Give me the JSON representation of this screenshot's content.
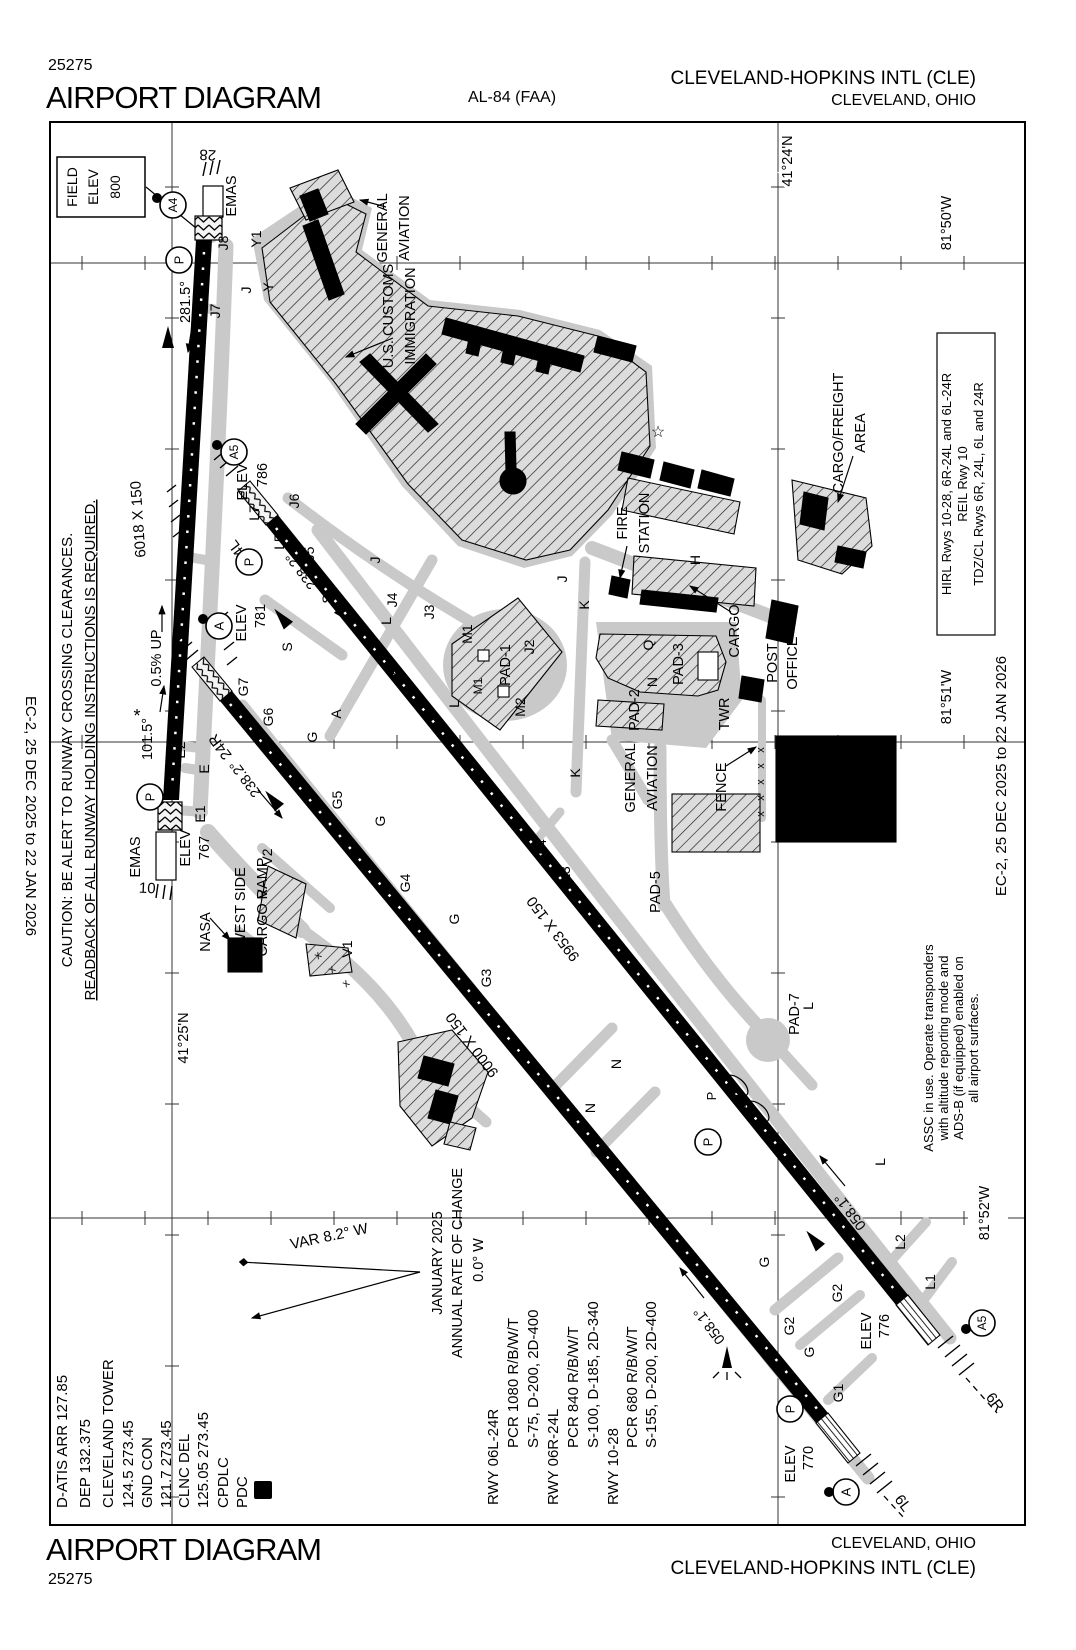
{
  "header": {
    "chart_id": "25275",
    "title": "AIRPORT DIAGRAM",
    "procedure_id": "AL-84 (FAA)",
    "airport_name": "CLEVELAND-HOPKINS INTL (CLE)",
    "city": "CLEVELAND, OHIO"
  },
  "footer": {
    "title": "AIRPORT DIAGRAM",
    "chart_id": "25275",
    "city": "CLEVELAND, OHIO",
    "airport_name": "CLEVELAND-HOPKINS INTL (CLE)"
  },
  "margins": {
    "left_date": "EC-2,  25 DEC 2025  to  22 JAN 2026",
    "right_date": "EC-2,  25 DEC 2025  to  22 JAN 2026"
  },
  "map": {
    "pdc_d": "D",
    "caution": [
      {
        "t": "CAUTION: BE ALERT TO RUNWAY CROSSING CLEARANCES.",
        "x": 72,
        "y": 750,
        "s": 15
      },
      {
        "t": "READBACK OF ALL RUNWAY HOLDING INSTRUCTIONS IS REQUIRED.",
        "x": 95,
        "y": 750,
        "s": 15,
        "u": 1
      }
    ],
    "frequencies": [
      {
        "t": "D-ATIS ARR 127.85",
        "x": 67,
        "y": 1508,
        "a": "s",
        "s": 15
      },
      {
        "t": "DEP 132.375",
        "x": 90,
        "y": 1508,
        "a": "s",
        "s": 15
      },
      {
        "t": "CLEVELAND TOWER",
        "x": 113,
        "y": 1508,
        "a": "s",
        "s": 15
      },
      {
        "t": "124.5  273.45",
        "x": 133,
        "y": 1508,
        "a": "s",
        "s": 15
      },
      {
        "t": "GND CON",
        "x": 152,
        "y": 1508,
        "a": "s",
        "s": 15
      },
      {
        "t": "121.7  273.45",
        "x": 171,
        "y": 1508,
        "a": "s",
        "s": 15
      },
      {
        "t": "CLNC DEL",
        "x": 189,
        "y": 1508,
        "a": "s",
        "s": 15
      },
      {
        "t": "125.05  273.45",
        "x": 208,
        "y": 1508,
        "a": "s",
        "s": 15
      },
      {
        "t": "CPDLC",
        "x": 228,
        "y": 1508,
        "a": "s",
        "s": 15
      },
      {
        "t": "PDC",
        "x": 247,
        "y": 1508,
        "a": "s",
        "s": 15
      }
    ],
    "runway_data": [
      {
        "t": "RWY 06L-24R",
        "x": 498,
        "y": 1505,
        "a": "s",
        "s": 15
      },
      {
        "t": "PCR 1080 R/B/W/T",
        "x": 518,
        "y": 1448,
        "a": "s",
        "s": 15
      },
      {
        "t": "S-75, D-200, 2D-400",
        "x": 538,
        "y": 1448,
        "a": "s",
        "s": 15
      },
      {
        "t": "RWY 06R-24L",
        "x": 558,
        "y": 1505,
        "a": "s",
        "s": 15
      },
      {
        "t": "PCR 840 R/B/W/T",
        "x": 578,
        "y": 1448,
        "a": "s",
        "s": 15
      },
      {
        "t": "S-100, D-185, 2D-340",
        "x": 598,
        "y": 1448,
        "a": "s",
        "s": 15
      },
      {
        "t": "RWY 10-28",
        "x": 618,
        "y": 1505,
        "a": "s",
        "s": 15
      },
      {
        "t": "PCR 680 R/B/W/T",
        "x": 637,
        "y": 1448,
        "a": "s",
        "s": 15
      },
      {
        "t": "S-155, D-200, 2D-400",
        "x": 656,
        "y": 1448,
        "a": "s",
        "s": 15
      }
    ],
    "lighting_note": [
      {
        "t": "HIRL Rwys 10-28, 6R-24L and 6L-24R",
        "x": 951,
        "y": 484,
        "s": 13
      },
      {
        "t": "REIL Rwy 10",
        "x": 967,
        "y": 484,
        "s": 13
      },
      {
        "t": "TDZ/CL Rwys 6R, 24L, 6L and 24R",
        "x": 983,
        "y": 484,
        "s": 13
      }
    ],
    "assc_note": [
      {
        "t": "ASSC in use. Operate transponders",
        "x": 933,
        "y": 1048,
        "s": 13
      },
      {
        "t": "with altitude reporting mode and",
        "x": 948,
        "y": 1048,
        "s": 13
      },
      {
        "t": "ADS-B (if equipped) enabled on",
        "x": 963,
        "y": 1048,
        "s": 13
      },
      {
        "t": "all airport surfaces.",
        "x": 978,
        "y": 1048,
        "s": 13
      }
    ],
    "field_elev_box": [
      {
        "t": "FIELD",
        "x": 77,
        "y": 187,
        "s": 14
      },
      {
        "t": "ELEV",
        "x": 98,
        "y": 187,
        "s": 14
      },
      {
        "t": "800",
        "x": 120,
        "y": 187,
        "s": 14
      }
    ],
    "labels": [
      {
        "t": "28",
        "x": 208,
        "y": 150,
        "r": 183,
        "s": 15
      },
      {
        "t": "EMAS",
        "x": 236,
        "y": 196
      },
      {
        "t": "J8",
        "x": 228,
        "y": 243,
        "s": 14
      },
      {
        "t": "J7",
        "x": 220,
        "y": 311,
        "s": 14
      },
      {
        "t": "Y1",
        "x": 261,
        "y": 239,
        "s": 14
      },
      {
        "t": "J",
        "x": 251,
        "y": 290,
        "s": 14
      },
      {
        "t": "Y",
        "x": 273,
        "y": 287,
        "s": 14
      },
      {
        "t": "281.5°",
        "x": 190,
        "y": 302
      },
      {
        "t": "6018 X 150",
        "x": 143,
        "y": 519,
        "r": -94,
        "s": 15
      },
      {
        "t": "0.5% UP",
        "x": 161,
        "y": 658
      },
      {
        "t": "101.5°",
        "x": 152,
        "y": 739
      },
      {
        "t": "*",
        "x": 137,
        "y": 722,
        "r": 0,
        "s": 18
      },
      {
        "t": "E2",
        "x": 185,
        "y": 750,
        "s": 14
      },
      {
        "t": "E",
        "x": 209,
        "y": 769,
        "s": 14
      },
      {
        "t": "E1",
        "x": 205,
        "y": 814,
        "s": 14
      },
      {
        "t": "EMAS",
        "x": 140,
        "y": 857
      },
      {
        "t": "10",
        "x": 147,
        "y": 893,
        "r": 3,
        "s": 15
      },
      {
        "t": "ELEV",
        "x": 190,
        "y": 848
      },
      {
        "t": "767",
        "x": 209,
        "y": 848
      },
      {
        "t": "GENERAL",
        "x": 387,
        "y": 228
      },
      {
        "t": "AVIATION",
        "x": 409,
        "y": 228
      },
      {
        "t": "U.S. CUSTOMS",
        "x": 393,
        "y": 316
      },
      {
        "t": "IMMIGRATION",
        "x": 415,
        "y": 316
      },
      {
        "t": "L7",
        "x": 259,
        "y": 513,
        "s": 14
      },
      {
        "t": "J6",
        "x": 299,
        "y": 501,
        "s": 14
      },
      {
        "t": "24L",
        "x": 243,
        "y": 549,
        "r": -127,
        "s": 15
      },
      {
        "t": "ELEV",
        "x": 247,
        "y": 482
      },
      {
        "t": "786",
        "x": 267,
        "y": 475
      },
      {
        "t": "S",
        "x": 332,
        "y": 599,
        "s": 14
      },
      {
        "t": "238.2°",
        "x": 305,
        "y": 568,
        "r": -127
      },
      {
        "t": "L5",
        "x": 284,
        "y": 542,
        "s": 14
      },
      {
        "t": "J5",
        "x": 314,
        "y": 554,
        "s": 14
      },
      {
        "t": "ELEV",
        "x": 246,
        "y": 623
      },
      {
        "t": "781",
        "x": 265,
        "y": 616
      },
      {
        "t": "S",
        "x": 292,
        "y": 647,
        "s": 14
      },
      {
        "t": "24R",
        "x": 224,
        "y": 744,
        "r": -127,
        "s": 15
      },
      {
        "t": "G7",
        "x": 248,
        "y": 687,
        "s": 14
      },
      {
        "t": "G6",
        "x": 273,
        "y": 717,
        "s": 14
      },
      {
        "t": "238.2°",
        "x": 249,
        "y": 776,
        "r": -127
      },
      {
        "t": "A",
        "x": 397,
        "y": 671,
        "s": 14
      },
      {
        "t": "A",
        "x": 341,
        "y": 714,
        "s": 14
      },
      {
        "t": "G",
        "x": 317,
        "y": 737,
        "s": 14
      },
      {
        "t": "J",
        "x": 380,
        "y": 560,
        "s": 14
      },
      {
        "t": "L",
        "x": 391,
        "y": 621,
        "s": 14
      },
      {
        "t": "J4",
        "x": 397,
        "y": 600,
        "s": 14
      },
      {
        "t": "J3",
        "x": 434,
        "y": 612,
        "s": 14
      },
      {
        "t": "J2",
        "x": 534,
        "y": 647,
        "s": 14
      },
      {
        "t": "L",
        "x": 459,
        "y": 704,
        "s": 14
      },
      {
        "t": "G5",
        "x": 342,
        "y": 800,
        "s": 14
      },
      {
        "t": "G",
        "x": 385,
        "y": 821,
        "s": 14
      },
      {
        "t": "G4",
        "x": 410,
        "y": 883,
        "s": 14
      },
      {
        "t": "G",
        "x": 459,
        "y": 919,
        "s": 14
      },
      {
        "t": "G3",
        "x": 491,
        "y": 978,
        "s": 14
      },
      {
        "t": "L4",
        "x": 546,
        "y": 847,
        "s": 14
      },
      {
        "t": "L3",
        "x": 570,
        "y": 874,
        "s": 14
      },
      {
        "t": "9953 X 150",
        "x": 557,
        "y": 926,
        "r": -127,
        "s": 15
      },
      {
        "t": "9000 X 150",
        "x": 476,
        "y": 1042,
        "r": -127,
        "s": 15
      },
      {
        "t": "J",
        "x": 567,
        "y": 579,
        "s": 14
      },
      {
        "t": "K",
        "x": 589,
        "y": 605,
        "s": 14
      },
      {
        "t": "H",
        "x": 700,
        "y": 560,
        "s": 14
      },
      {
        "t": "FIRE",
        "x": 627,
        "y": 523
      },
      {
        "t": "STATION",
        "x": 649,
        "y": 523
      },
      {
        "t": "CARGO",
        "x": 739,
        "y": 631
      },
      {
        "t": "POST",
        "x": 777,
        "y": 663
      },
      {
        "t": "OFFICE",
        "x": 797,
        "y": 663
      },
      {
        "t": "TWR",
        "x": 729,
        "y": 714
      },
      {
        "t": "Q",
        "x": 653,
        "y": 645,
        "s": 14
      },
      {
        "t": "N",
        "x": 657,
        "y": 682,
        "s": 14
      },
      {
        "t": "PAD-1",
        "x": 510,
        "y": 665
      },
      {
        "t": "M1",
        "x": 472,
        "y": 634,
        "s": 14
      },
      {
        "t": "M1",
        "x": 482,
        "y": 686,
        "s": 12
      },
      {
        "t": "M2",
        "x": 525,
        "y": 707,
        "s": 14
      },
      {
        "t": "PAD-2",
        "x": 639,
        "y": 710
      },
      {
        "t": "PAD-3",
        "x": 683,
        "y": 664
      },
      {
        "t": "FENCE",
        "x": 726,
        "y": 787
      },
      {
        "t": "K",
        "x": 580,
        "y": 773,
        "s": 14
      },
      {
        "t": "GENERAL",
        "x": 635,
        "y": 778
      },
      {
        "t": "AVIATION",
        "x": 657,
        "y": 778
      },
      {
        "t": "CARGO/FREIGHT",
        "x": 843,
        "y": 433
      },
      {
        "t": "AREA",
        "x": 865,
        "y": 433
      },
      {
        "t": "☆",
        "x": 658,
        "y": 437,
        "r": 0,
        "s": 16
      },
      {
        "t": "PAD-5",
        "x": 660,
        "y": 892
      },
      {
        "t": "PAD-7",
        "x": 799,
        "y": 1014
      },
      {
        "t": "L",
        "x": 813,
        "y": 1006,
        "s": 14
      },
      {
        "t": "L",
        "x": 885,
        "y": 1162,
        "s": 14
      },
      {
        "t": "N",
        "x": 595,
        "y": 1108,
        "s": 14
      },
      {
        "t": "N",
        "x": 621,
        "y": 1064,
        "s": 14
      },
      {
        "t": "P",
        "x": 716,
        "y": 1096,
        "s": 13
      },
      {
        "t": "x",
        "x": 764,
        "y": 750,
        "s": 11
      },
      {
        "t": "x",
        "x": 764,
        "y": 766,
        "s": 11
      },
      {
        "t": "x",
        "x": 764,
        "y": 782,
        "s": 11
      },
      {
        "t": "x",
        "x": 764,
        "y": 798,
        "s": 11
      },
      {
        "t": "x",
        "x": 764,
        "y": 814,
        "s": 11
      },
      {
        "t": "NASA",
        "x": 210,
        "y": 932
      },
      {
        "t": "WEST SIDE",
        "x": 245,
        "y": 907
      },
      {
        "t": "CARGO RAMP",
        "x": 267,
        "y": 907
      },
      {
        "t": "V2",
        "x": 272,
        "y": 857,
        "s": 14
      },
      {
        "t": "V",
        "x": 267,
        "y": 894,
        "s": 14
      },
      {
        "t": "V1",
        "x": 352,
        "y": 949,
        "s": 14
      },
      {
        "t": "x",
        "x": 320,
        "y": 958,
        "r": -40,
        "s": 11
      },
      {
        "t": "x",
        "x": 334,
        "y": 972,
        "r": -40,
        "s": 11
      },
      {
        "t": "x",
        "x": 348,
        "y": 986,
        "r": -40,
        "s": 11
      },
      {
        "t": "ELEV",
        "x": 871,
        "y": 1331
      },
      {
        "t": "776",
        "x": 889,
        "y": 1326
      },
      {
        "t": "058.1°",
        "x": 854,
        "y": 1209,
        "r": -127
      },
      {
        "t": "6R",
        "x": 991,
        "y": 1405,
        "r": 53,
        "s": 15
      },
      {
        "t": "L2",
        "x": 905,
        "y": 1242,
        "s": 14
      },
      {
        "t": "L1",
        "x": 935,
        "y": 1282,
        "s": 14
      },
      {
        "t": "G2",
        "x": 842,
        "y": 1293,
        "s": 14
      },
      {
        "t": "G2",
        "x": 794,
        "y": 1326,
        "s": 14
      },
      {
        "t": "G",
        "x": 769,
        "y": 1262,
        "s": 14
      },
      {
        "t": "G",
        "x": 814,
        "y": 1352,
        "s": 14
      },
      {
        "t": "G1",
        "x": 843,
        "y": 1393,
        "s": 14
      },
      {
        "t": "058.1°",
        "x": 713,
        "y": 1323,
        "r": -127
      },
      {
        "t": "ELEV",
        "x": 795,
        "y": 1464
      },
      {
        "t": "770",
        "x": 813,
        "y": 1458
      },
      {
        "t": "6L",
        "x": 899,
        "y": 1506,
        "r": 53,
        "s": 15
      },
      {
        "t": "41°24'N",
        "x": 792,
        "y": 161,
        "h": 1
      },
      {
        "t": "41°25'N",
        "x": 188,
        "y": 1038,
        "h": 1
      },
      {
        "t": "81°50'W",
        "x": 951,
        "y": 223,
        "h": 1
      },
      {
        "t": "81°51'W",
        "x": 951,
        "y": 697,
        "h": 1
      },
      {
        "t": "81°52'W",
        "x": 989,
        "y": 1213,
        "h": 1
      },
      {
        "t": "VAR 8.2° W",
        "x": 330,
        "y": 1241,
        "r": -12,
        "s": 15
      },
      {
        "t": "JANUARY 2025",
        "x": 442,
        "y": 1263
      },
      {
        "t": "ANNUAL RATE OF CHANGE",
        "x": 462,
        "y": 1263
      },
      {
        "t": "0.0° W",
        "x": 483,
        "y": 1260
      }
    ],
    "hold_circles": [
      {
        "t": "P",
        "x": 179,
        "y": 260
      },
      {
        "t": "A4",
        "x": 173,
        "y": 205,
        "dx": 157,
        "dy": 198
      },
      {
        "t": "A5",
        "x": 234,
        "y": 452,
        "dx": 217,
        "dy": 445
      },
      {
        "t": "P",
        "x": 249,
        "y": 562
      },
      {
        "t": "A",
        "x": 219,
        "y": 626,
        "dx": 203,
        "dy": 619
      },
      {
        "t": "P",
        "x": 150,
        "y": 797
      },
      {
        "t": "A5",
        "x": 982,
        "y": 1323,
        "dx": 966,
        "dy": 1329
      },
      {
        "t": "A",
        "x": 846,
        "y": 1492,
        "dx": 829,
        "dy": 1492
      },
      {
        "t": "P",
        "x": 790,
        "y": 1409
      },
      {
        "t": "P",
        "x": 708,
        "y": 1142
      }
    ],
    "colors": {
      "taxiway": "#c9c9c9",
      "runway": "#000000",
      "ink": "#000000"
    }
  }
}
